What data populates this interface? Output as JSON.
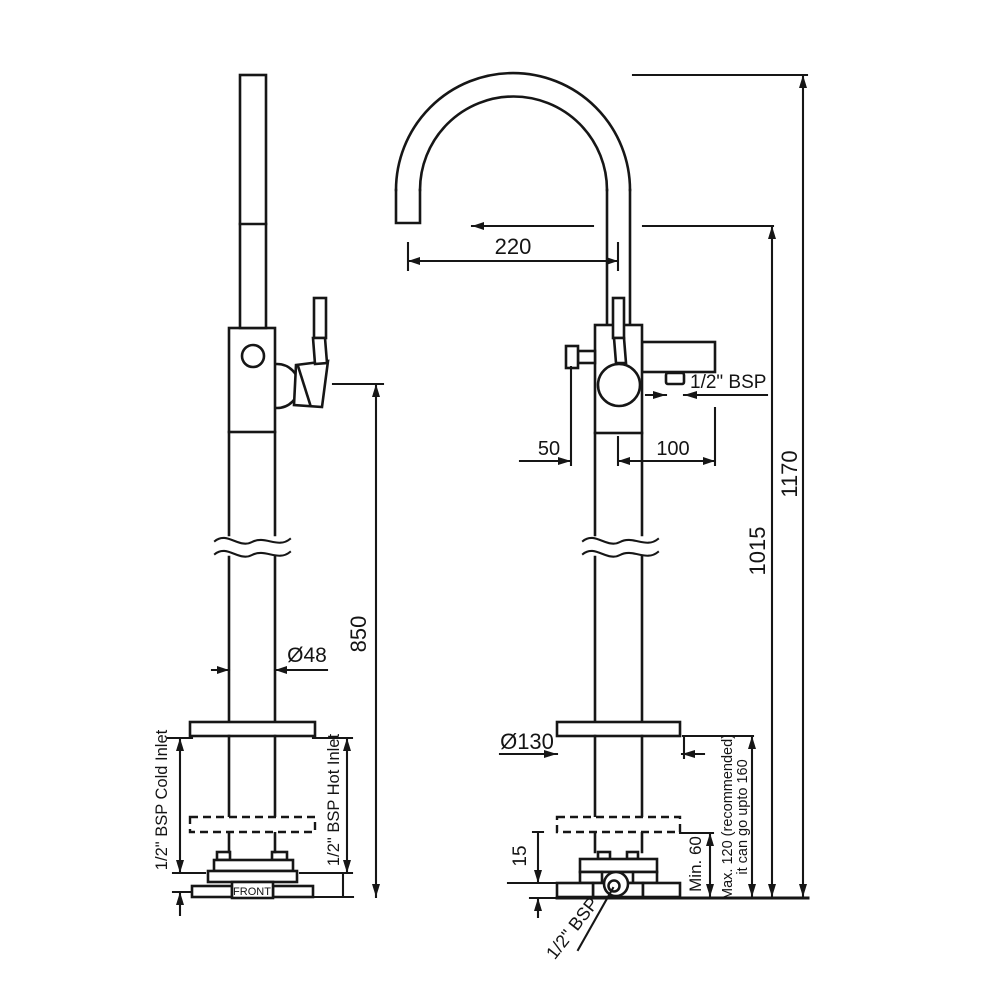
{
  "side_view": {
    "dim_height": "850",
    "dim_diameter": "Ø48",
    "cold_inlet_label": "1/2\" BSP Cold Inlet",
    "hot_inlet_label": "1/2\" BSP Hot Inlet",
    "front_label": "FRONT"
  },
  "front_view": {
    "dim_spout_reach": "220",
    "dim_handle_offset": "50",
    "dim_outlet_offset": "100",
    "outlet_thread_label": "1/2\" BSP",
    "dim_spout_height": "1015",
    "dim_total_height": "1170",
    "dim_base_diameter": "Ø130",
    "dim_base_plate_height": "15",
    "min_plate_label": "Min. 60",
    "max_plate_label_line1": "Max. 120 (recommended)",
    "max_plate_label_line2": "it can go upto 160",
    "inlet_thread_label": "1/2\" BSP"
  }
}
